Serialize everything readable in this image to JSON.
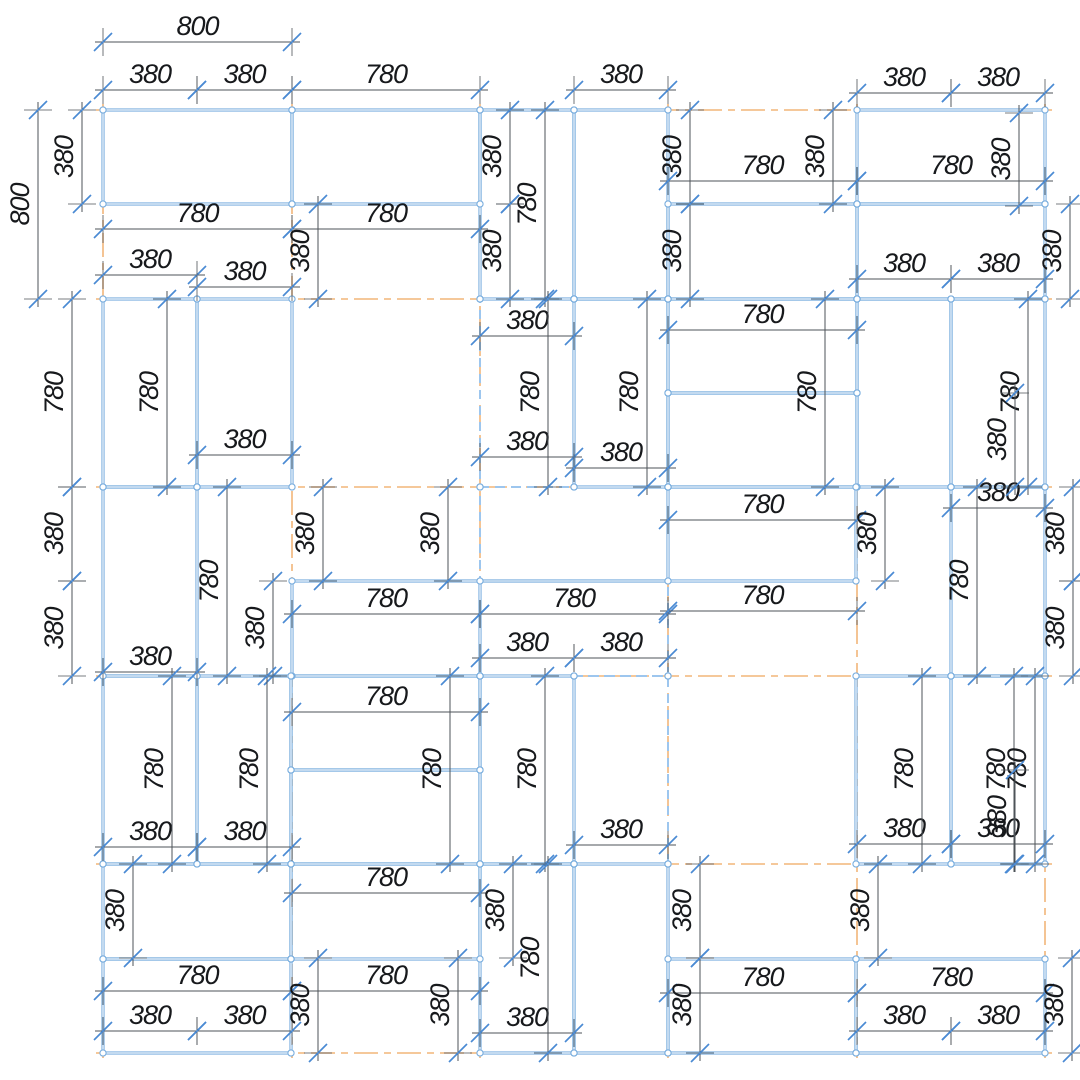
{
  "drawing": {
    "title": "panel-layout-plan",
    "width": 1080,
    "height": 1080,
    "colors": {
      "background": "#ffffff",
      "panel_edge": "#7aaede",
      "panel_edge_inner": "#ffffff",
      "panel_dashed": "#9dc6ee",
      "grid_centerline": "#f2b579",
      "dim_line": "#4d5358",
      "tick": "#4a8ad4",
      "node_fill": "#ffffff",
      "node_stroke": "#7aaede",
      "label_text": "#17191c"
    },
    "label_font_size": 27
  },
  "grid": {
    "vertical_x": [
      103,
      292,
      480,
      668,
      857,
      1045
    ],
    "vertical_y_span": [
      104,
      1058
    ],
    "horizontal_y": [
      110,
      299,
      487,
      676,
      864,
      1053
    ],
    "horizontal_x_span": [
      96,
      1052
    ]
  },
  "panels": {
    "solid": [
      [
        103,
        110,
        189,
        94
      ],
      [
        292,
        110,
        188,
        94
      ],
      [
        480,
        110,
        94,
        189
      ],
      [
        574,
        110,
        94,
        189
      ],
      [
        668,
        204,
        189,
        95
      ],
      [
        857,
        110,
        188,
        94
      ],
      [
        857,
        204,
        188,
        95
      ],
      [
        103,
        299,
        94,
        188
      ],
      [
        197,
        299,
        95,
        188
      ],
      [
        857,
        299,
        94,
        188
      ],
      [
        951,
        299,
        94,
        188
      ],
      [
        668,
        299,
        189,
        94
      ],
      [
        668,
        393,
        189,
        94
      ],
      [
        574,
        299,
        94,
        188
      ],
      [
        103,
        487,
        94,
        189
      ],
      [
        292,
        581,
        188,
        95
      ],
      [
        856,
        959,
        189,
        94
      ],
      [
        668,
        959,
        188,
        94
      ],
      [
        574,
        864,
        94,
        189
      ],
      [
        480,
        864,
        94,
        189
      ],
      [
        291,
        864,
        189,
        95
      ],
      [
        103,
        959,
        188,
        94
      ],
      [
        103,
        864,
        188,
        95
      ],
      [
        951,
        676,
        94,
        188
      ],
      [
        856,
        676,
        95,
        188
      ],
      [
        197,
        676,
        94,
        188
      ],
      [
        103,
        676,
        94,
        188
      ],
      [
        291,
        770,
        189,
        94
      ],
      [
        291,
        676,
        189,
        94
      ],
      [
        480,
        676,
        94,
        188
      ],
      [
        951,
        487,
        94,
        189
      ],
      [
        668,
        487,
        188,
        94
      ]
    ],
    "dashed": [
      [
        480,
        299,
        94,
        188
      ],
      [
        480,
        487,
        188,
        189
      ],
      [
        574,
        676,
        94,
        188
      ]
    ],
    "extra_edges": [
      [
        480,
        581,
        668,
        581
      ]
    ]
  },
  "dimensions": [
    [
      "h",
      103,
      292,
      42,
      "800"
    ],
    [
      "h",
      103,
      197,
      90,
      "380"
    ],
    [
      "h",
      197,
      292,
      90,
      "380"
    ],
    [
      "h",
      292,
      480,
      90,
      "780"
    ],
    [
      "h",
      574,
      668,
      90,
      "380"
    ],
    [
      "h",
      857,
      951,
      93,
      "380"
    ],
    [
      "h",
      951,
      1045,
      93,
      "380"
    ],
    [
      "h",
      668,
      857,
      181,
      "780"
    ],
    [
      "h",
      857,
      1045,
      181,
      "780"
    ],
    [
      "h",
      103,
      292,
      229,
      "780"
    ],
    [
      "h",
      292,
      480,
      229,
      "780"
    ],
    [
      "h",
      103,
      197,
      275,
      "380"
    ],
    [
      "h",
      197,
      292,
      287,
      "380"
    ],
    [
      "h",
      857,
      951,
      279,
      "380"
    ],
    [
      "h",
      951,
      1045,
      279,
      "380"
    ],
    [
      "h",
      668,
      857,
      330,
      "780"
    ],
    [
      "h",
      480,
      574,
      336,
      "380"
    ],
    [
      "h",
      197,
      292,
      455,
      "380"
    ],
    [
      "h",
      480,
      574,
      457,
      "380"
    ],
    [
      "h",
      574,
      668,
      468,
      "380"
    ],
    [
      "h",
      668,
      857,
      520,
      "780"
    ],
    [
      "h",
      951,
      1045,
      508,
      "380"
    ],
    [
      "h",
      292,
      480,
      614,
      "780"
    ],
    [
      "h",
      480,
      668,
      614,
      "780"
    ],
    [
      "h",
      668,
      857,
      611,
      "780"
    ],
    [
      "h",
      480,
      574,
      658,
      "380"
    ],
    [
      "h",
      574,
      668,
      658,
      "380"
    ],
    [
      "h",
      103,
      197,
      672,
      "380"
    ],
    [
      "h",
      292,
      480,
      712,
      "780"
    ],
    [
      "h",
      574,
      668,
      845,
      "380"
    ],
    [
      "h",
      103,
      197,
      847,
      "380"
    ],
    [
      "h",
      197,
      292,
      847,
      "380"
    ],
    [
      "h",
      857,
      951,
      844,
      "380"
    ],
    [
      "h",
      951,
      1045,
      844,
      "380"
    ],
    [
      "h",
      292,
      480,
      893,
      "780"
    ],
    [
      "h",
      103,
      292,
      991,
      "780"
    ],
    [
      "h",
      292,
      480,
      991,
      "780"
    ],
    [
      "h",
      668,
      857,
      993,
      "780"
    ],
    [
      "h",
      857,
      1045,
      993,
      "780"
    ],
    [
      "h",
      103,
      197,
      1031,
      "380"
    ],
    [
      "h",
      197,
      292,
      1031,
      "380"
    ],
    [
      "h",
      480,
      574,
      1033,
      "380"
    ],
    [
      "h",
      857,
      951,
      1031,
      "380"
    ],
    [
      "h",
      951,
      1045,
      1031,
      "380"
    ],
    [
      "v",
      110,
      299,
      38,
      "800"
    ],
    [
      "v",
      110,
      204,
      82,
      "380"
    ],
    [
      "v",
      204,
      299,
      318,
      "380"
    ],
    [
      "v",
      110,
      204,
      510,
      "380"
    ],
    [
      "v",
      204,
      299,
      510,
      "380"
    ],
    [
      "v",
      110,
      299,
      545,
      "780"
    ],
    [
      "v",
      110,
      204,
      690,
      "380"
    ],
    [
      "v",
      204,
      299,
      690,
      "380"
    ],
    [
      "v",
      110,
      204,
      833,
      "380"
    ],
    [
      "v",
      113,
      206,
      1019,
      "380"
    ],
    [
      "v",
      204,
      299,
      1070,
      "380"
    ],
    [
      "v",
      299,
      487,
      72,
      "780"
    ],
    [
      "v",
      299,
      487,
      167,
      "780"
    ],
    [
      "v",
      299,
      487,
      548,
      "780"
    ],
    [
      "v",
      299,
      487,
      647,
      "780"
    ],
    [
      "v",
      299,
      487,
      825,
      "780"
    ],
    [
      "v",
      299,
      487,
      1028,
      "780"
    ],
    [
      "v",
      393,
      487,
      1015,
      "380"
    ],
    [
      "v",
      487,
      581,
      72,
      "380"
    ],
    [
      "v",
      581,
      676,
      72,
      "380"
    ],
    [
      "v",
      487,
      676,
      227,
      "780"
    ],
    [
      "v",
      581,
      676,
      273,
      "380"
    ],
    [
      "v",
      487,
      581,
      323,
      "380"
    ],
    [
      "v",
      487,
      581,
      448,
      "380"
    ],
    [
      "v",
      487,
      581,
      885,
      "380"
    ],
    [
      "v",
      487,
      676,
      977,
      "780"
    ],
    [
      "v",
      487,
      581,
      1073,
      "380"
    ],
    [
      "v",
      581,
      676,
      1073,
      "380"
    ],
    [
      "v",
      676,
      864,
      172,
      "780"
    ],
    [
      "v",
      676,
      864,
      267,
      "780"
    ],
    [
      "v",
      676,
      864,
      450,
      "780"
    ],
    [
      "v",
      676,
      864,
      545,
      "780"
    ],
    [
      "v",
      676,
      864,
      922,
      "780"
    ],
    [
      "v",
      676,
      864,
      1014,
      "780"
    ],
    [
      "v",
      676,
      864,
      1035,
      "780"
    ],
    [
      "v",
      770,
      864,
      1015,
      "380"
    ],
    [
      "v",
      864,
      958,
      133,
      "380"
    ],
    [
      "v",
      864,
      958,
      513,
      "380"
    ],
    [
      "v",
      864,
      1053,
      548,
      "780"
    ],
    [
      "v",
      864,
      958,
      878,
      "380"
    ],
    [
      "v",
      864,
      958,
      700,
      "380"
    ],
    [
      "v",
      958,
      1053,
      700,
      "380"
    ],
    [
      "v",
      958,
      1053,
      458,
      "380"
    ],
    [
      "v",
      958,
      1053,
      318,
      "380"
    ],
    [
      "v",
      958,
      1053,
      1072,
      "380"
    ]
  ]
}
